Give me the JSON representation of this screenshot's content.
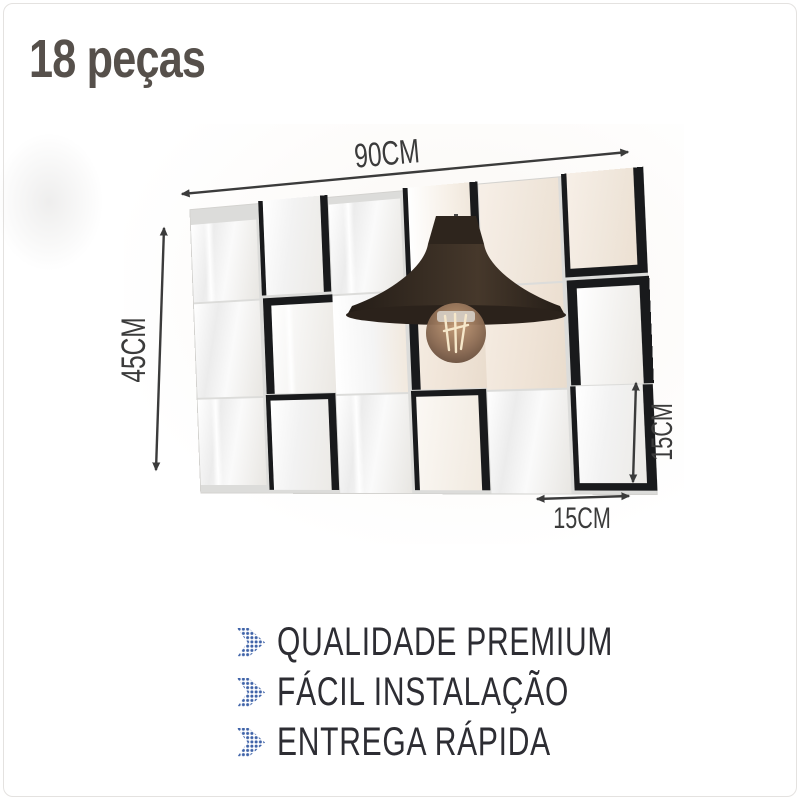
{
  "card": {
    "title": "18 peças"
  },
  "figure": {
    "grid": {
      "rows": 3,
      "cols": 6,
      "tile_count": 18
    },
    "annotations": {
      "panel_width": "90CM",
      "panel_height": "45CM",
      "tile_height": "15CM",
      "tile_width": "15CM"
    }
  },
  "features": {
    "items": [
      {
        "label": "QUALIDADE PREMIUM"
      },
      {
        "label": "FÁCIL INSTALAÇÃO"
      },
      {
        "label": "ENTREGA RÁPIDA"
      }
    ]
  },
  "colors": {
    "accent_blue": "#3f63a8",
    "title_text": "#56504b",
    "feature_text": "#2d2d33",
    "annotation_text": "#3b3b3b",
    "tile_edge": "#191a1c",
    "warm_reflection": "#f0e7dc",
    "card_border": "#e4e2e0"
  }
}
